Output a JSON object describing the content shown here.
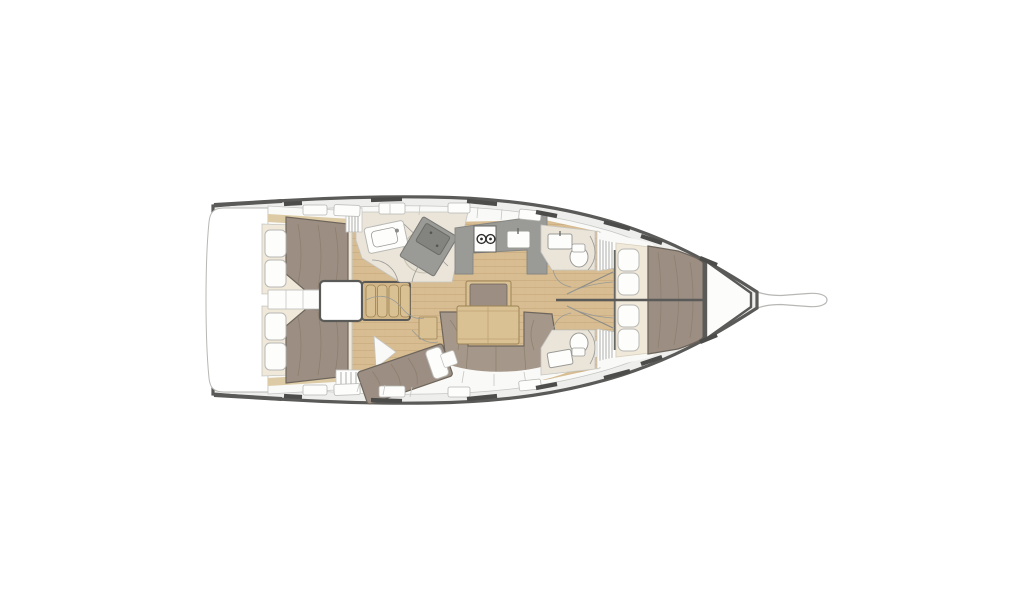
{
  "diagram": {
    "type": "sailing-yacht-interior-floor-plan",
    "orientation": "bow-right",
    "areas": [
      "swim-platform",
      "transom",
      "aft-cabin-port",
      "aft-cabin-starboard",
      "passage-lockers",
      "engine-compartment",
      "companionway-steps",
      "aft-heads-with-shower",
      "nav-station",
      "galley",
      "stove-two-burners",
      "galley-sink",
      "salon-table",
      "salon-bench-seat",
      "salon-sofa",
      "mid-cabin-starboard-double-berth",
      "forward-heads-port",
      "forward-heads-starboard",
      "hanging-lockers",
      "owner-cabin-v-berth",
      "bed-pillows",
      "bow-sail-locker",
      "bowsprit",
      "deck-hatches",
      "deck-cleats"
    ]
  },
  "colors": {
    "page_bg": "#ffffff",
    "hull_outline": "#5a5a58",
    "deck": "#eeeeec",
    "deck_line": "#b7b7b4",
    "wall": "#f9f9f7",
    "wall_line": "#c6c6c3",
    "fixture_white": "#fdfdfc",
    "wood": "#d8bd92",
    "wood_line": "#b89a6c",
    "wood_trim": "#ddcba6",
    "table_wood": "#d9c194",
    "table_line": "#9b8354",
    "steps_wood": "#d3b788",
    "mattress": "#9c8e82",
    "mattress_line": "#6e665c",
    "mattress_fold": "#82745f",
    "cream": "#f0e9da",
    "pillow": "#fdfdfc",
    "pillow_line": "#b8b8b4",
    "counter": "#9a9a97",
    "counter_dark": "#83837f",
    "bath_floor": "#eae4d9",
    "shower_pan": "#e6e0d4",
    "sofa": "#a5978a",
    "sofa_line": "#7b7267",
    "dark_line": "#666663",
    "sketch_line": "#9a9a96"
  }
}
